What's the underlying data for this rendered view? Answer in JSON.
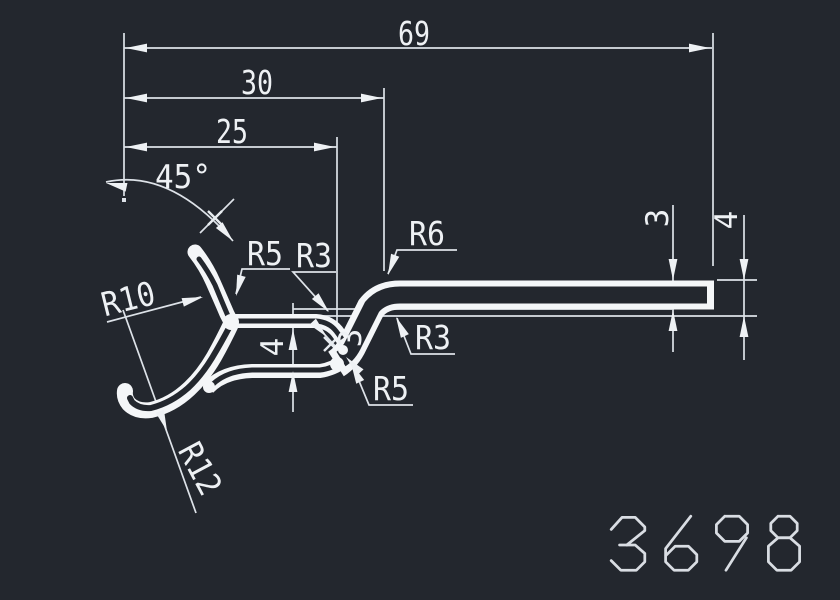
{
  "drawing": {
    "number": "3698",
    "type_note": "profile-cross-section"
  },
  "dims": {
    "overall_width": "69",
    "mid_width": "30",
    "inner_width": "25",
    "angle": "45°",
    "channel_gap": "4",
    "wall_thickness": "3",
    "flange_thickness": "3",
    "flange_height": "4"
  },
  "radii": {
    "r5_top": "R5",
    "r3_mid": "R3",
    "r6_top": "R6",
    "r3_right": "R3",
    "r5_bottom": "R5",
    "r10": "R10",
    "r12": "R12"
  },
  "colors": {
    "background": "#23272e",
    "lines": "#eef1f4",
    "profile": "#f4f6f8",
    "drawing_number": "#d9dde3"
  }
}
